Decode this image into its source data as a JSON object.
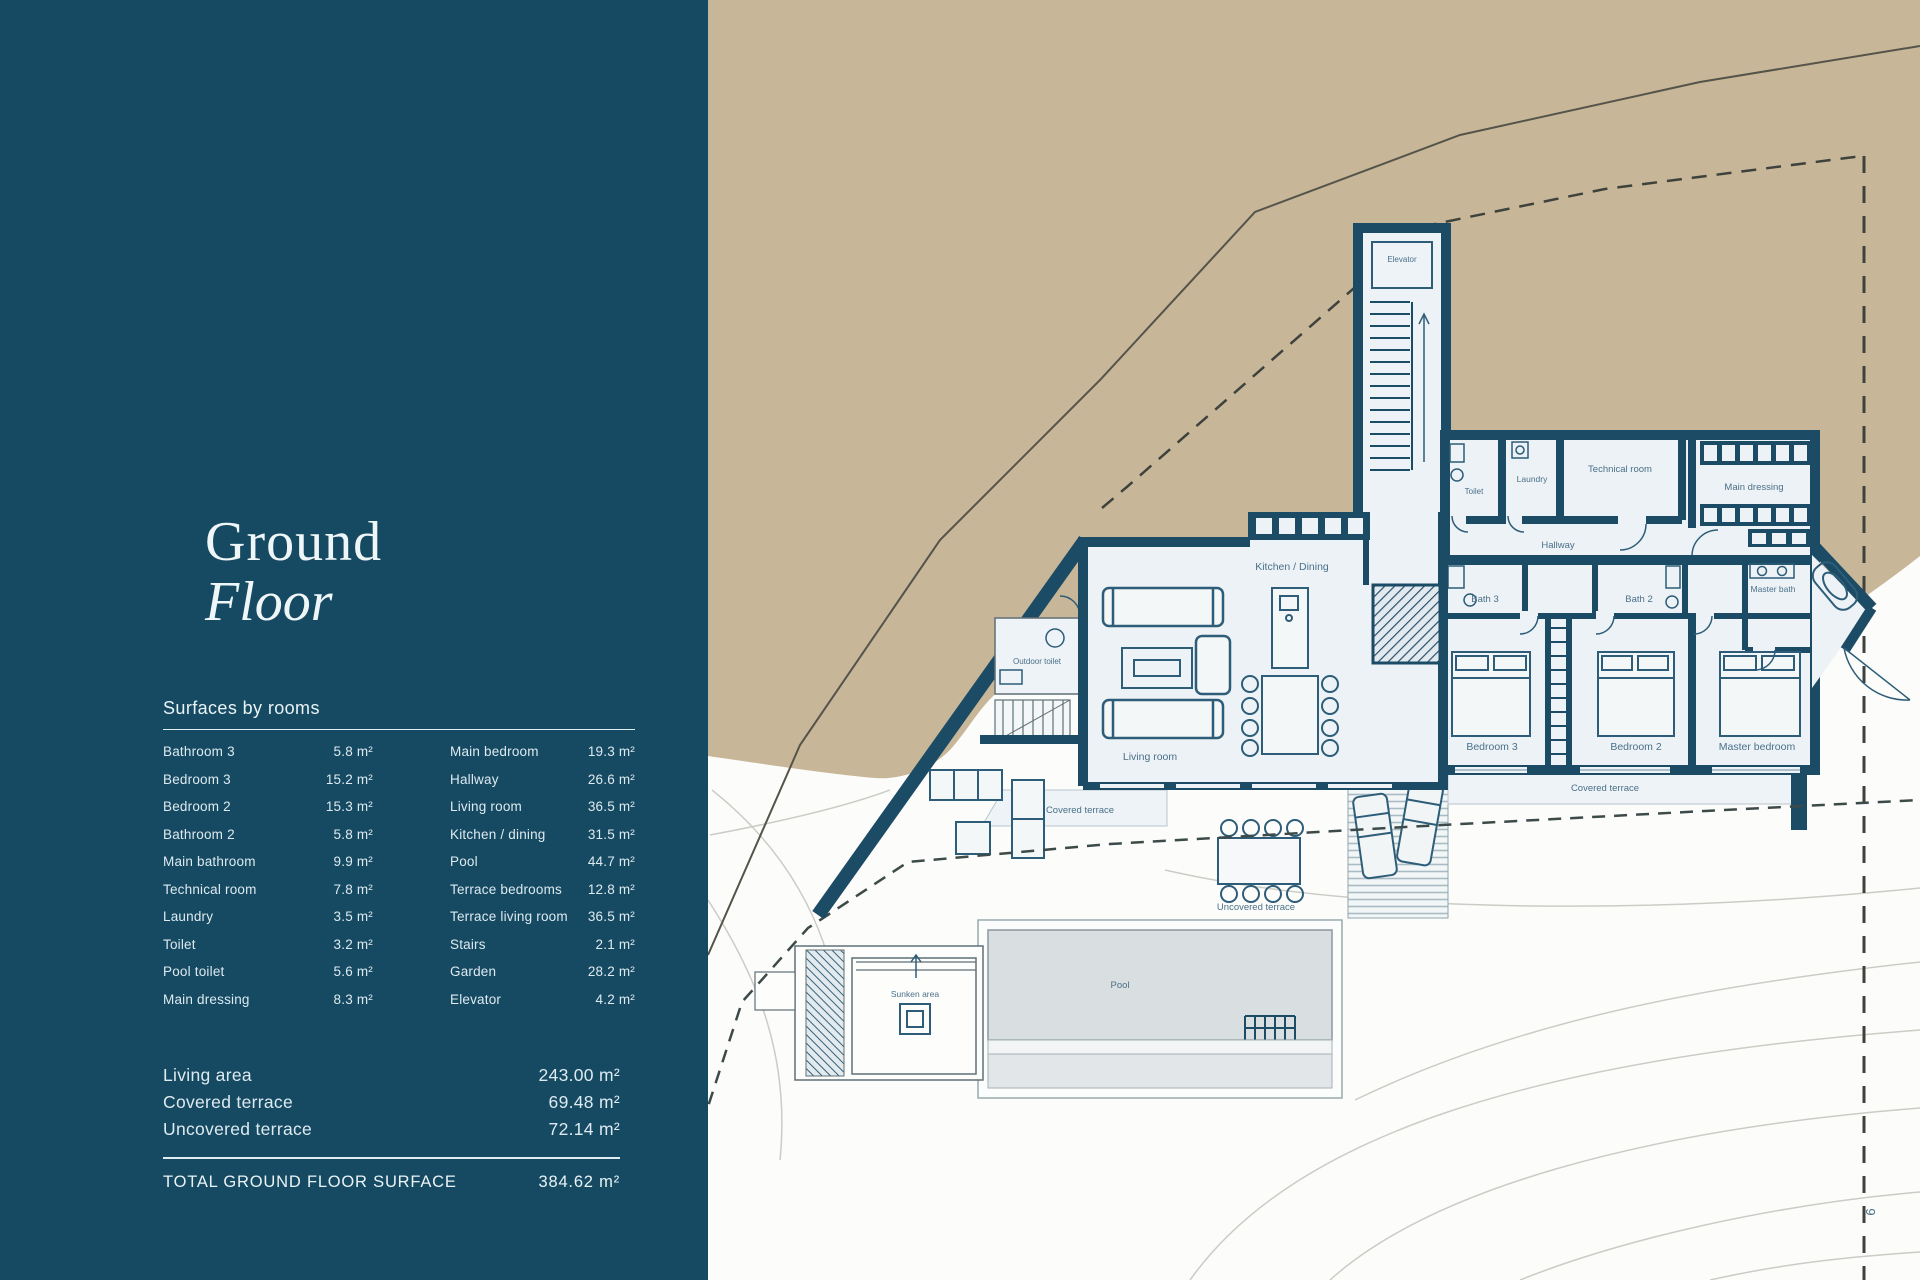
{
  "sidebar": {
    "title_line1": "Ground",
    "title_line2": "Floor",
    "table_header": "Surfaces by rooms",
    "rooms_left": [
      {
        "label": "Bathroom 3",
        "value": "5.8 m²"
      },
      {
        "label": "Bedroom 3",
        "value": "15.2 m²"
      },
      {
        "label": "Bedroom 2",
        "value": "15.3 m²"
      },
      {
        "label": "Bathroom 2",
        "value": "5.8 m²"
      },
      {
        "label": "Main bathroom",
        "value": "9.9 m²"
      },
      {
        "label": "Technical room",
        "value": "7.8 m²"
      },
      {
        "label": "Laundry",
        "value": "3.5 m²"
      },
      {
        "label": "Toilet",
        "value": "3.2 m²"
      },
      {
        "label": "Pool toilet",
        "value": "5.6 m²"
      },
      {
        "label": "Main dressing",
        "value": "8.3 m²"
      }
    ],
    "rooms_right": [
      {
        "label": "Main bedroom",
        "value": "19.3 m²"
      },
      {
        "label": "Hallway",
        "value": "26.6 m²"
      },
      {
        "label": "Living room",
        "value": "36.5 m²"
      },
      {
        "label": "Kitchen / dining",
        "value": "31.5 m²"
      },
      {
        "label": "Pool",
        "value": "44.7 m²"
      },
      {
        "label": "Terrace bedrooms",
        "value": "12.8 m²"
      },
      {
        "label": "Terrace living room",
        "value": "36.5 m²"
      },
      {
        "label": "Stairs",
        "value": "2.1 m²"
      },
      {
        "label": "Garden",
        "value": "28.2 m²"
      },
      {
        "label": "Elevator",
        "value": "4.2 m²"
      }
    ],
    "totals": [
      {
        "label": "Living area",
        "value": "243.00 m²"
      },
      {
        "label": "Covered terrace",
        "value": "69.48 m²"
      },
      {
        "label": "Uncovered terrace",
        "value": "72.14 m²"
      }
    ],
    "grand_total": {
      "label": "TOTAL GROUND FLOOR SURFACE",
      "value": "384.62 m²"
    }
  },
  "plan": {
    "labels": {
      "elevator": "Elevator",
      "toilet": "Toilet",
      "laundry": "Laundry",
      "technical_room": "Technical room",
      "main_dressing": "Main dressing",
      "hallway": "Hallway",
      "bath_3": "Bath 3",
      "bath_2": "Bath 2",
      "master_bath": "Master bath",
      "kitchen_dining": "Kitchen / Dining",
      "living_room": "Living room",
      "outdoor_toilet": "Outdoor toilet",
      "bedroom_3": "Bedroom 3",
      "bedroom_2": "Bedroom 2",
      "master_bedroom": "Master bedroom",
      "covered_terrace_bedrooms": "Covered terrace",
      "covered_terrace_living": "Covered terrace",
      "uncovered_terrace": "Uncovered terrace",
      "pool": "Pool",
      "sunken_area": "Sunken area"
    },
    "page_number": "9"
  },
  "colors": {
    "sidebar_bg": "#164a62",
    "sidebar_text": "#ddeaf0",
    "site_tan": "#c8b698",
    "wall": "#1c4b66",
    "room_fill": "#edf2f6",
    "pool_water": "#d9dfe1",
    "furniture_line": "#2d5d78",
    "plan_label": "#4a7088"
  }
}
